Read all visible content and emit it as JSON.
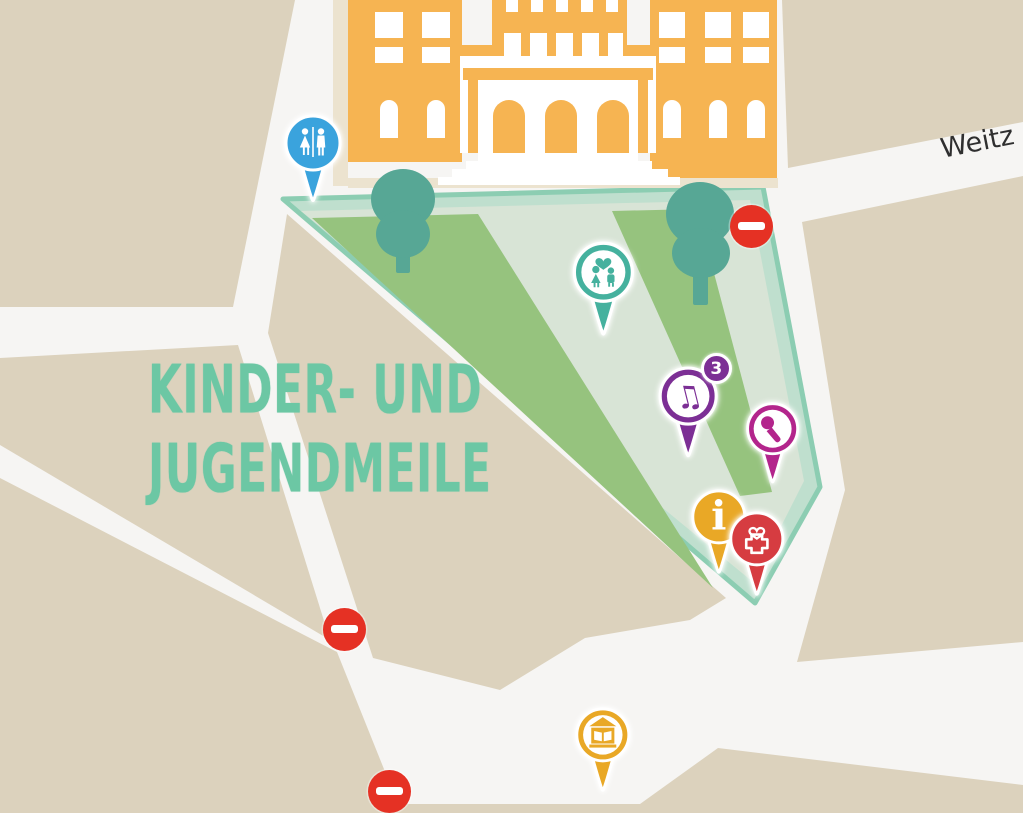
{
  "map": {
    "area_label": {
      "line1": "KINDER- UND",
      "line2": "JUGENDMEILE",
      "color": "#6cc7a4"
    },
    "street": {
      "name": "Weitz",
      "color": "#2f2f2f"
    },
    "background_color": "#dcd2bd",
    "road_color": "#f6f5f3",
    "no_entry_color": "#e53124",
    "park": {
      "border_color": "#8ccdb2",
      "band_color": "#bfdfce",
      "inner_color": "#d8e4d6",
      "lawn_color": "#96c37e",
      "tree_color": "#57a795"
    },
    "building_color": "#f6b452"
  },
  "markers": [
    {
      "id": "toilets",
      "icon": "wc-icon",
      "color": "#3aa3dd",
      "x": 313,
      "y": 143,
      "r": 27,
      "inner_disc": false
    },
    {
      "id": "family-area",
      "icon": "family-icon",
      "color": "#45b19e",
      "x": 603,
      "y": 272,
      "r": 29,
      "inner_disc": true
    },
    {
      "id": "music-stage",
      "icon": "music-icon",
      "color": "#7c2f95",
      "x": 688,
      "y": 396,
      "r": 28,
      "inner_disc": true,
      "badge": "3"
    },
    {
      "id": "karaoke",
      "icon": "microphone-icon",
      "color": "#b3258c",
      "x": 773,
      "y": 429,
      "r": 25,
      "inner_disc": true
    },
    {
      "id": "information",
      "icon": "info-icon",
      "color": "#e9a826",
      "x": 719,
      "y": 517,
      "r": 26,
      "inner_disc": false
    },
    {
      "id": "first-aid",
      "icon": "first-aid-icon",
      "color": "#d63c41",
      "x": 757,
      "y": 539,
      "r": 26,
      "inner_disc": false
    },
    {
      "id": "kids-house",
      "icon": "library-icon",
      "color": "#e9a826",
      "x": 603,
      "y": 735,
      "r": 26,
      "inner_disc": true
    }
  ],
  "no_entry_signs": [
    {
      "x": 751,
      "y": 226
    },
    {
      "x": 344,
      "y": 629
    },
    {
      "x": 389,
      "y": 791
    }
  ]
}
